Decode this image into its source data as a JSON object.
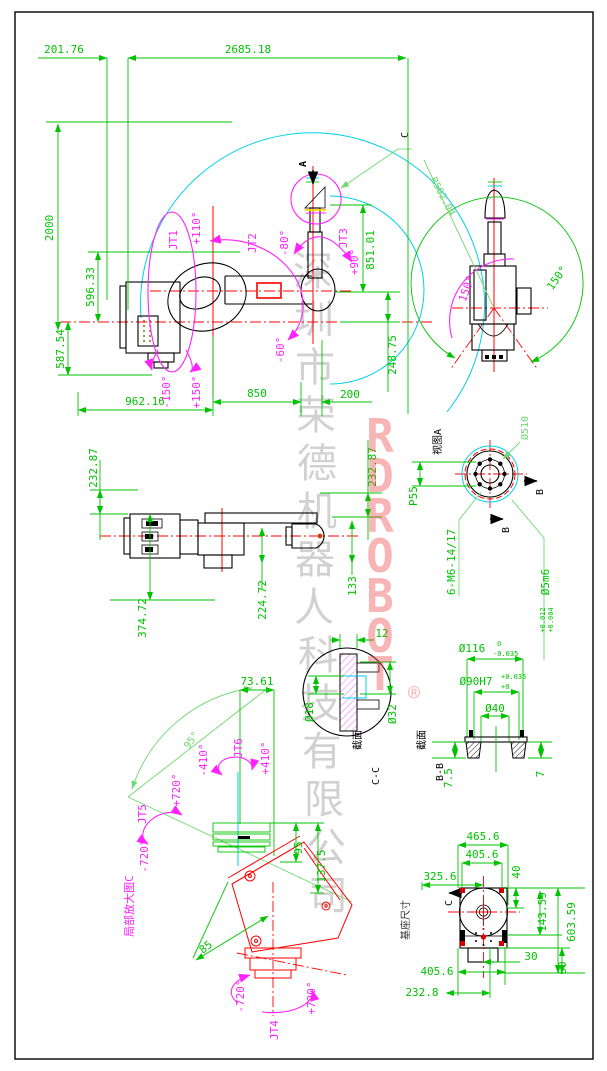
{
  "watermark": {
    "letters": [
      "R",
      "D",
      "R",
      "O",
      "B",
      "O",
      "T"
    ],
    "registered": "®",
    "company_chars": [
      "深",
      "圳",
      "市",
      "荣",
      "德",
      "机",
      "器",
      "人",
      "科",
      "技",
      "有",
      "限",
      "公",
      "司"
    ]
  },
  "colors": {
    "dimension_green": "#00c300",
    "leader_green": "#6fd86f",
    "joint_magenta": "#ff22ff",
    "centerline_red": "#ff0000",
    "envelope_cyan": "#00d0e4",
    "outline_black": "#000000"
  },
  "side_view": {
    "dim_a": "201.76",
    "dim_b": "2685.18",
    "dim_c": "2000",
    "dim_d": "596.33",
    "dim_e": "587.54",
    "dim_f": "962.16",
    "dim_g": "850",
    "dim_h": "200",
    "dim_i": "248.75",
    "dim_j": "851.01",
    "marker_a": "A",
    "marker_c": "C",
    "jt1_label": "JT1",
    "jt1_neg": "-150°",
    "jt1_pos": "+150°",
    "jt2_label": "JT2",
    "jt2_pos": "+110°",
    "jt2_neg": "-60°",
    "jt3_label": "JT3",
    "jt3_neg": "-80°",
    "jt3_pos": "+90°"
  },
  "rear_view": {
    "radius": "R502.04",
    "angle_left": "150°",
    "angle_right": "150°"
  },
  "flange_view": {
    "title": "视图A",
    "dia": "Ø510",
    "pcd": "P55",
    "b1": "B",
    "b2": "B",
    "bolts": "6-M6-14/17",
    "pin": "Ø5m6",
    "pin_hi": "+0.012",
    "pin_lo": "+0.004"
  },
  "plan_view": {
    "dim_left": "232.87",
    "dim_right": "232.87",
    "dim_a": "374.72",
    "dim_b": "224.72",
    "dim_c": "133"
  },
  "section_cc": {
    "label": "截面",
    "name": "C-C",
    "dim_a": "12",
    "dim_b": "Ø18",
    "dim_c": "Ø32"
  },
  "section_bb": {
    "label": "截面",
    "name": "B-B",
    "dim_a": "Ø116",
    "dim_a_hi": "0",
    "dim_a_lo": "-0.035",
    "dim_b": "Ø90H7",
    "dim_b_hi": "+0.035",
    "dim_b_lo": "+0",
    "dim_c": "Ø40",
    "dim_d": "7.5",
    "dim_e": "7"
  },
  "detail_view": {
    "title": "局部放大图C",
    "dim_a": "73.61",
    "dim_b": "95",
    "dim_c": "137.5",
    "dim_d": "85",
    "angle": "95°",
    "jt4_label": "JT4",
    "jt4_neg": "-720°",
    "jt4_pos": "+720°",
    "jt5_label": "JT5",
    "jt5_pos": "+720°",
    "jt5_neg": "-720°",
    "jt6_label": "JT6",
    "jt6_neg": "-410°",
    "jt6_pos": "+410°"
  },
  "base_view": {
    "title": "基座尺寸",
    "marker_c": "C",
    "dim_a": "465.6",
    "dim_b": "405.6",
    "dim_c": "40",
    "dim_d": "325.6",
    "dim_e": "143.59",
    "dim_f": "603.59",
    "dim_g": "30",
    "dim_h": "60",
    "dim_i": "405.6",
    "dim_j": "232.8"
  }
}
